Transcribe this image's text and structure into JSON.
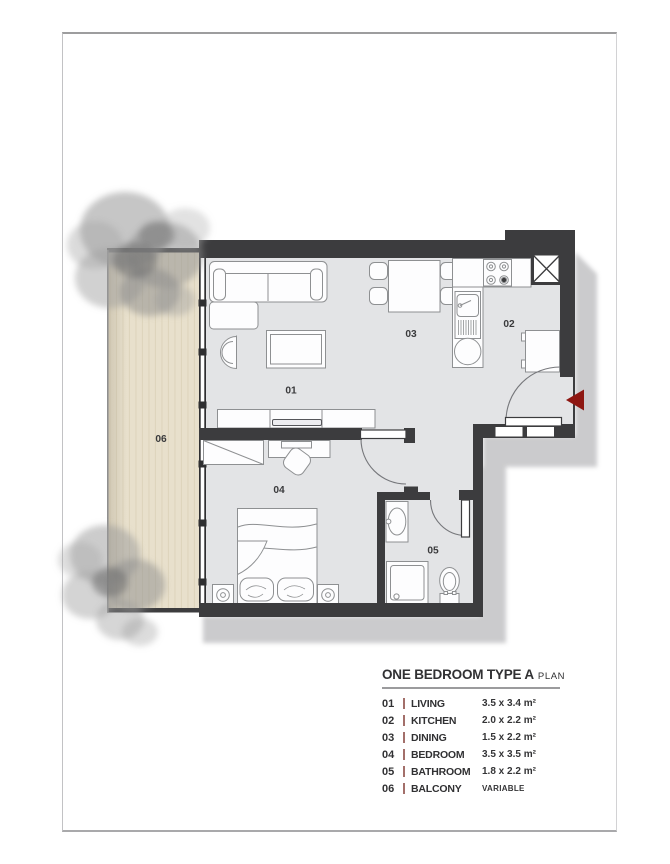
{
  "title": {
    "main": "ONE BEDROOM TYPE A",
    "suffix": "PLAN"
  },
  "legend_rows": [
    {
      "num": "01",
      "name": "LIVING",
      "area": "3.5 x 3.4 m²"
    },
    {
      "num": "02",
      "name": "KITCHEN",
      "area": "2.0 x 2.2 m²"
    },
    {
      "num": "03",
      "name": "DINING",
      "area": "1.5 x 2.2 m²"
    },
    {
      "num": "04",
      "name": "BEDROOM",
      "area": "3.5 x 3.5 m²"
    },
    {
      "num": "05",
      "name": "BATHROOM",
      "area": "1.8 x 2.2 m²"
    },
    {
      "num": "06",
      "name": "BALCONY",
      "area": "VARIABLE"
    }
  ],
  "room_labels": {
    "living": "01",
    "kitchen": "02",
    "dining": "03",
    "bedroom": "04",
    "bathroom": "05",
    "balcony": "06"
  },
  "colors": {
    "wall": "#3c3c3e",
    "floor": "#e3e4e6",
    "balcony_floor": "#e8e0cc",
    "shadow": "#c6c6c8",
    "entry_arrow": "#8e1712",
    "legend_separator": "#a36f6a",
    "frame_border": "#9d9d9e"
  }
}
